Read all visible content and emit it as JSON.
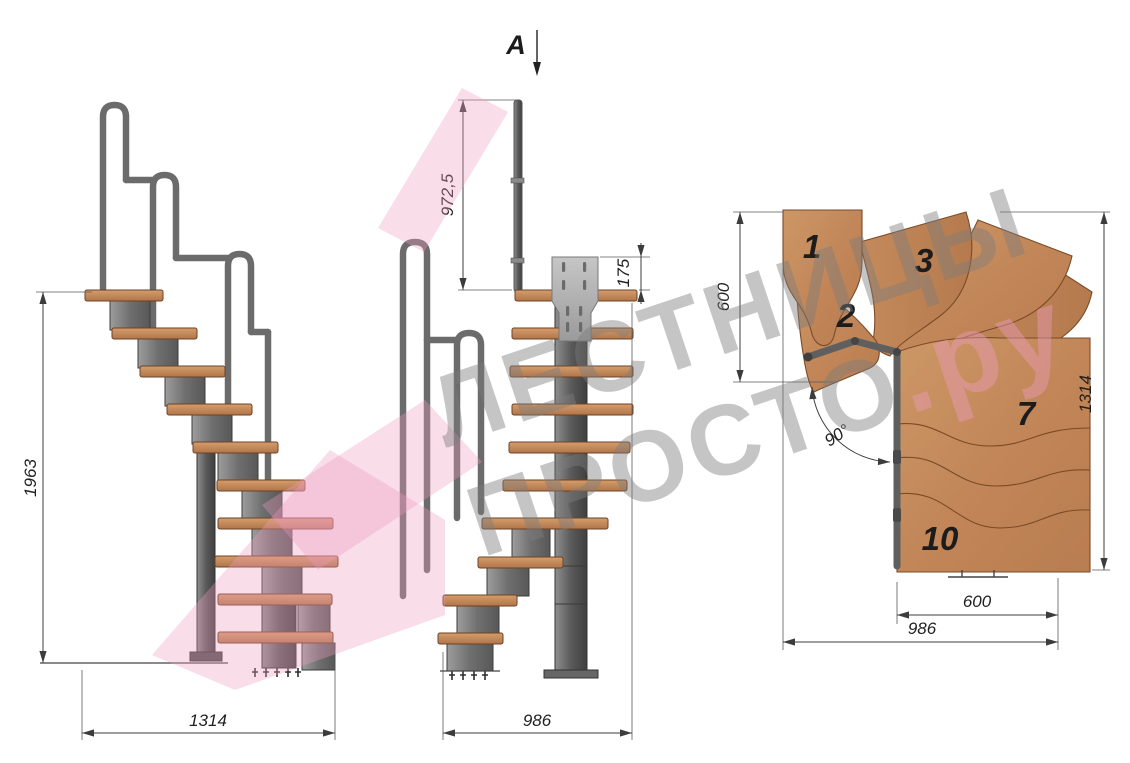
{
  "watermark": {
    "line1": "ЛЕСТНИЦЫ",
    "line2": "ПРОСТО",
    "domain_suffix": ".ру"
  },
  "front_view": {
    "section_marker": "A",
    "dim_handrail_height": "972,5",
    "dim_bracket_height": "175",
    "dim_total_width": "986"
  },
  "side_view": {
    "dim_total_height": "1963",
    "dim_total_length": "1314"
  },
  "plan_view": {
    "dim_step_depth": "600",
    "dim_flight_length": "1314",
    "dim_turn_angle": "90°",
    "dim_lower_width": "600",
    "dim_overall_width": "986",
    "step_labels": [
      "1",
      "2",
      "3",
      "7",
      "10"
    ]
  },
  "colors": {
    "background": "#ffffff",
    "wood": "#c68c5d",
    "wood_dark": "#a9713f",
    "steel": "#787878",
    "steel_dark": "#4a4a4a",
    "dimension": "#3c3c3c",
    "watermark_gray": "#7d7d7d",
    "watermark_pink": "#ec9cbe"
  }
}
